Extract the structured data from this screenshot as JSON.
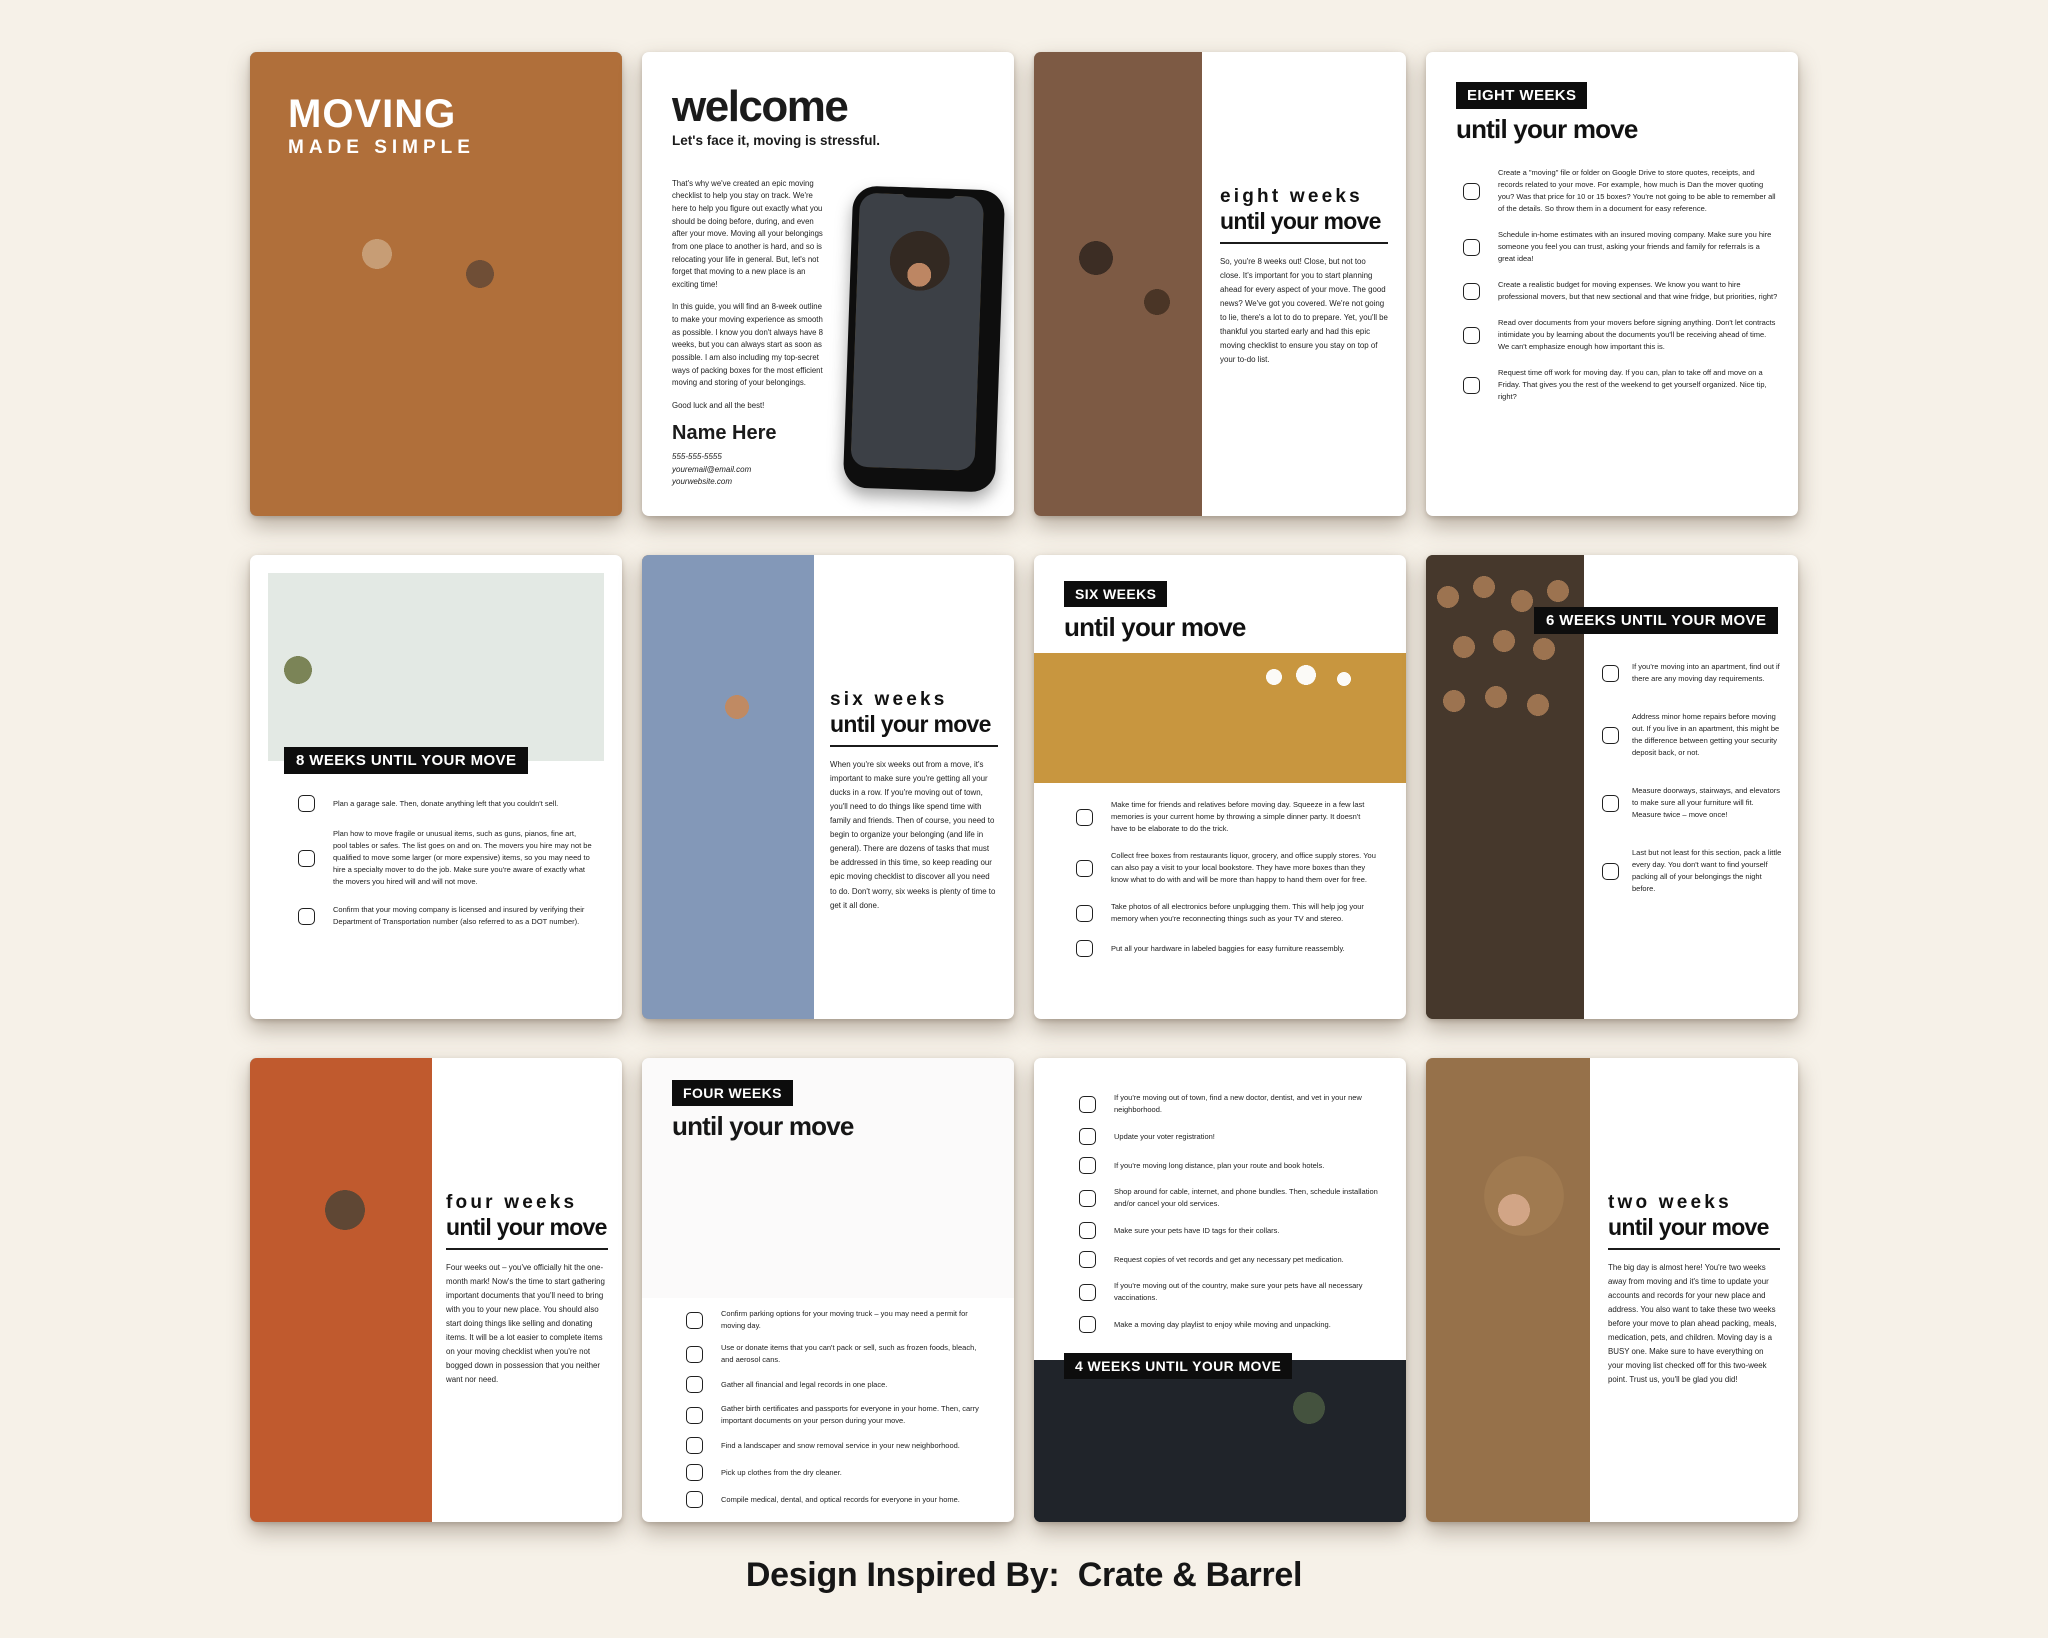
{
  "colors": {
    "board_bg": "#f6f1e8",
    "page_bg": "#ffffff",
    "badge_bg": "#0d0d0d",
    "badge_text": "#ffffff",
    "text": "#1b1b1b"
  },
  "caption": "Design Inspired By:  Crate & Barrel",
  "pages": {
    "cover": {
      "title": "MOVING",
      "subtitle": "MADE SIMPLE"
    },
    "welcome": {
      "title": "welcome",
      "subtitle": "Let's face it, moving is stressful.",
      "p1": "That's why we've created an epic moving checklist to help you stay on track. We're here to help you figure out exactly what you should be doing before, during, and even after your move. Moving all your belongings from one place to another is hard, and so is relocating your life in general. But, let's not forget that moving to a new place is an exciting time!",
      "p2": "In this guide, you will find an 8-week outline to make your moving experience as smooth as possible. I know you don't always have 8 weeks, but you can always start as soon as possible. I am also including my top-secret ways of packing boxes for the most efficient moving and storing of your belongings.",
      "p3": "Good luck and all the best!",
      "name": "Name Here",
      "phone": "555-555-5555",
      "email": "youremail@email.com",
      "website": "yourwebsite.com"
    },
    "eight_intro": {
      "heading1": "eight weeks",
      "heading2": "until your move",
      "body": "So, you're 8 weeks out! Close, but not too close. It's important for you to start planning ahead for every aspect of your move. The good news? We've got you covered. We're not going to lie, there's a lot to do to prepare. Yet, you'll be thankful you started early and had this epic moving checklist to ensure you stay on top of your to-do list."
    },
    "eight_list": {
      "badge": "EIGHT WEEKS",
      "heading": "until your move",
      "items": [
        "Create a \"moving\" file or folder on Google Drive to store quotes, receipts, and records related to your move. For example, how much is Dan the mover quoting you? Was that price for 10 or 15 boxes? You're not going to be able to remember all of the details. So throw them in a document for easy reference.",
        "Schedule in-home estimates with an insured moving company. Make sure you hire someone you feel you can trust, asking your friends and family for referrals is a great idea!",
        "Create a realistic budget for moving expenses. We know you want to hire professional movers, but that new sectional and that wine fridge, but priorities, right?",
        "Read over documents from your movers before signing anything. Don't let contracts intimidate you by learning about the documents you'll be receiving ahead of time. We can't emphasize enough how important this is.",
        "Request time off work for moving day. If you can, plan to take off and move on a Friday. That gives you the rest of the weekend to get yourself organized. Nice tip, right?"
      ]
    },
    "eight_tasks": {
      "badge": "8 WEEKS UNTIL YOUR MOVE",
      "items": [
        "Plan a garage sale. Then, donate anything left that you couldn't sell.",
        "Plan how to move fragile or unusual items, such as guns, pianos, fine art, pool tables or safes. The list goes on and on. The movers you hire may not be qualified to move some larger (or more expensive) items, so you may need to hire a specialty mover to do the job. Make sure you're aware of exactly what the movers you hired will and will not move.",
        "Confirm that your moving company is licensed and insured by verifying their Department of Transportation number (also referred to as a DOT number)."
      ]
    },
    "six_intro": {
      "heading1": "six weeks",
      "heading2": "until your move",
      "body": "When you're six weeks out from a move, it's important to make sure you're getting all your ducks in a row. If you're moving out of town, you'll need to do things like spend time with family and friends. Then of course, you need to begin to organize your belonging (and life in general). There are dozens of tasks that must be addressed in this time, so keep reading our epic moving checklist to discover all you need to do. Don't worry, six weeks is plenty of time to get it all done."
    },
    "six_list": {
      "badge": "SIX WEEKS",
      "heading": "until your move",
      "items": [
        "Make time for friends and relatives before moving day. Squeeze in a few last memories is your current home by throwing a simple dinner party. It doesn't have to be elaborate to do the trick.",
        "Collect free boxes from restaurants liquor, grocery, and office supply stores. You can also pay a visit to your local bookstore. They have more boxes than they know what to do with and will be more than happy to hand them over for free.",
        "Take photos of all electronics before unplugging them. This will help jog your memory when you're reconnecting things such as your TV and stereo.",
        "Put all your hardware in labeled baggies for easy furniture reassembly."
      ]
    },
    "six_tasks": {
      "badge": "6 WEEKS UNTIL YOUR MOVE",
      "items": [
        "If you're moving into an apartment, find out if there are any moving day requirements.",
        "Address minor home repairs before moving out. If you live in an apartment, this might be the difference between getting your security deposit back, or not.",
        "Measure doorways, stairways, and elevators to make sure all your furniture will fit. Measure twice – move once!",
        "Last but not least for this section, pack a little every day. You don't want to find yourself packing all of your belongings the night before."
      ]
    },
    "four_intro": {
      "heading1": "four weeks",
      "heading2": "until your move",
      "body": "Four weeks out – you've officially hit the one-month mark! Now's the time to start gathering important documents that you'll need to bring with you to your new place. You should also start doing things like selling and donating items. It will be a lot easier to complete items on your moving checklist when you're not bogged down in possession that you neither want nor need."
    },
    "four_list": {
      "badge": "FOUR WEEKS",
      "heading": "until your move",
      "items": [
        "Confirm parking options for your moving truck – you may need a permit for moving day.",
        "Use or donate items that you can't pack or sell, such as frozen foods, bleach, and aerosol cans.",
        "Gather all financial and legal records in one place.",
        "Gather birth certificates and passports for everyone in your home. Then, carry important documents on your person during your move.",
        "Find a landscaper and snow removal service in your new neighborhood.",
        "Pick up clothes from the dry cleaner.",
        "Compile medical, dental, and optical records for everyone in your home."
      ]
    },
    "four_tasks": {
      "badge": "4 WEEKS UNTIL YOUR MOVE",
      "items": [
        "If you're moving out of town, find a new doctor, dentist, and vet in your new neighborhood.",
        "Update your voter registration!",
        "If you're moving long distance, plan your route and book hotels.",
        "Shop around for cable, internet, and phone bundles. Then, schedule installation and/or cancel your old services.",
        "Make sure your pets have ID tags for their collars.",
        "Request copies of vet records and get any necessary pet medication.",
        "If you're moving out of the country, make sure your pets have all necessary vaccinations.",
        "Make a moving day playlist to enjoy while moving and unpacking."
      ]
    },
    "two_intro": {
      "heading1": "two weeks",
      "heading2": "until your move",
      "body": "The big day is almost here! You're two weeks away from moving and it's time to update your accounts and records for your new place and address. You also want to take these two weeks before your move to plan ahead packing, meals, medication, pets, and children. Moving day is a BUSY one. Make sure to have everything on your moving list checked off for this two-week point. Trust us, you'll be glad you did!"
    }
  }
}
